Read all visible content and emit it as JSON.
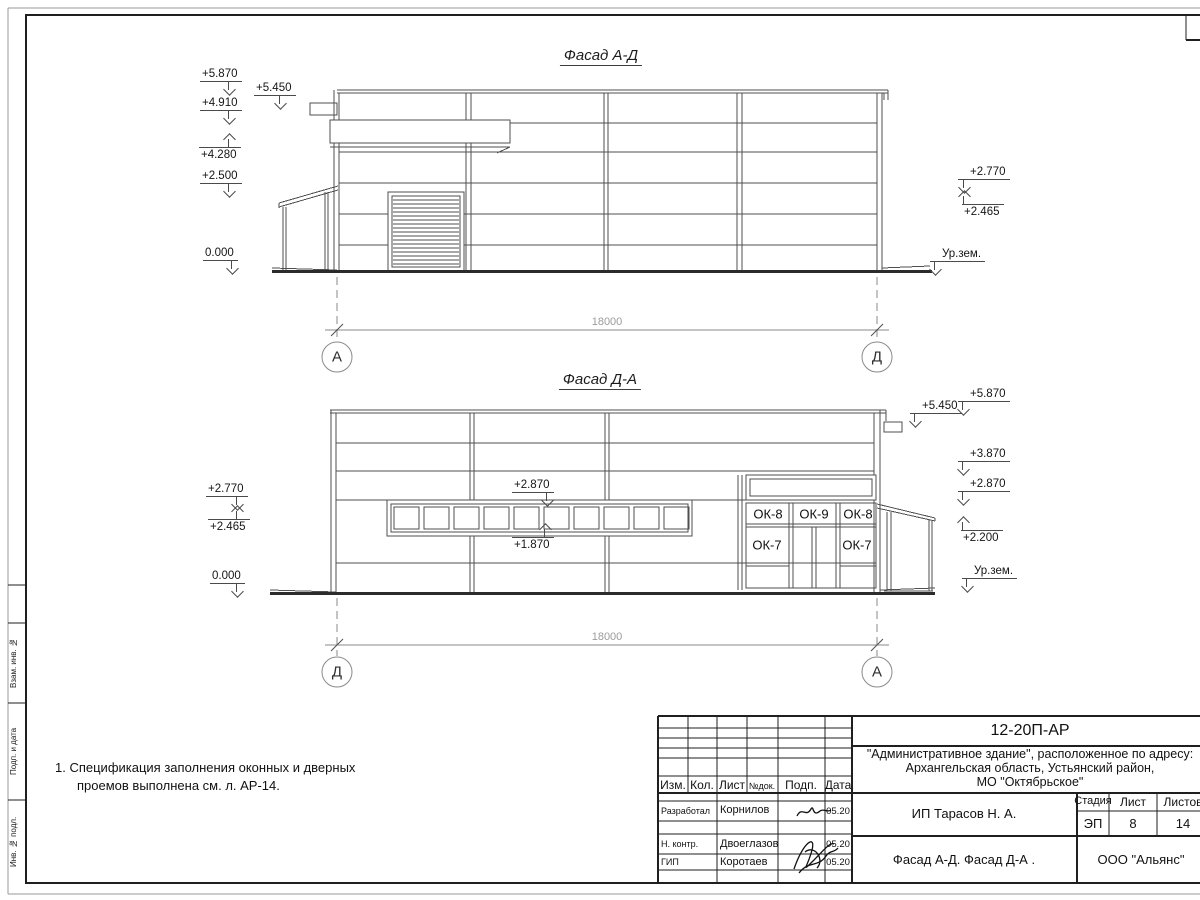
{
  "colors": {
    "line": "#4f4f4f",
    "frame": "#1f1f1f",
    "ground": "#2b2b2b",
    "dim": "#9b9b9b",
    "axis": "#8a8a8a"
  },
  "note": {
    "line1": "1. Спецификация заполнения оконных и дверных",
    "line2": "проемов выполнена см. л. АР-14."
  },
  "strip": {
    "c1": "Взам. инв. №",
    "c2": "Подп. и дата",
    "c3": "Инв. № подл."
  },
  "top": {
    "title": "Фасад А-Д",
    "dim": "18000",
    "ax_l": "А",
    "ax_r": "Д",
    "m5870": "+5.870",
    "m5450": "+5.450",
    "m4910": "+4.910",
    "m4280": "+4.280",
    "m2500": "+2.500",
    "m0": "0.000",
    "m2770": "+2.770",
    "m2465": "+2.465",
    "ground": "Ур.зем."
  },
  "bottom": {
    "title": "Фасад Д-А",
    "dim": "18000",
    "ax_l": "Д",
    "ax_r": "А",
    "m2770": "+2.770",
    "m2465": "+2.465",
    "m0": "0.000",
    "m2870": "+2.870",
    "m1870": "+1.870",
    "m5870": "+5.870",
    "m5450": "+5.450",
    "m3870": "+3.870",
    "m2870r": "+2.870",
    "m2200": "+2.200",
    "ground": "Ур.зем.",
    "ok8a": "ОК-8",
    "ok9": "ОК-9",
    "ok8b": "ОК-8",
    "ok7a": "ОК-7",
    "ok7b": "ОК-7"
  },
  "tb": {
    "doc": "12-20П-АР",
    "addr1": "\"Административное здание\", расположенное по адресу:",
    "addr2": "Архангельская область, Устьянский район,",
    "addr3": "МО \"Октябрьское\"",
    "h_izm": "Изм.",
    "h_kol": "Кол.",
    "h_list": "Лист",
    "h_ndok": "№док.",
    "h_podp": "Подп.",
    "h_data": "Дата",
    "r1_role": "Разработал",
    "r1_name": "Корнилов",
    "r1_date": "05.20",
    "r2_role": "Н. контр.",
    "r2_name": "Двоеглазов",
    "r2_date": "05.20",
    "r3_role": "ГИП",
    "r3_name": "Коротаев",
    "r3_date": "05.20",
    "client": "ИП Тарасов Н. А.",
    "h_stage": "Стадия",
    "h_sheet": "Лист",
    "h_sheets": "Листов",
    "stage": "ЭП",
    "sheet": "8",
    "sheets": "14",
    "name": "Фасад А-Д. Фасад Д-А .",
    "company": "ООО \"Альянс\""
  }
}
